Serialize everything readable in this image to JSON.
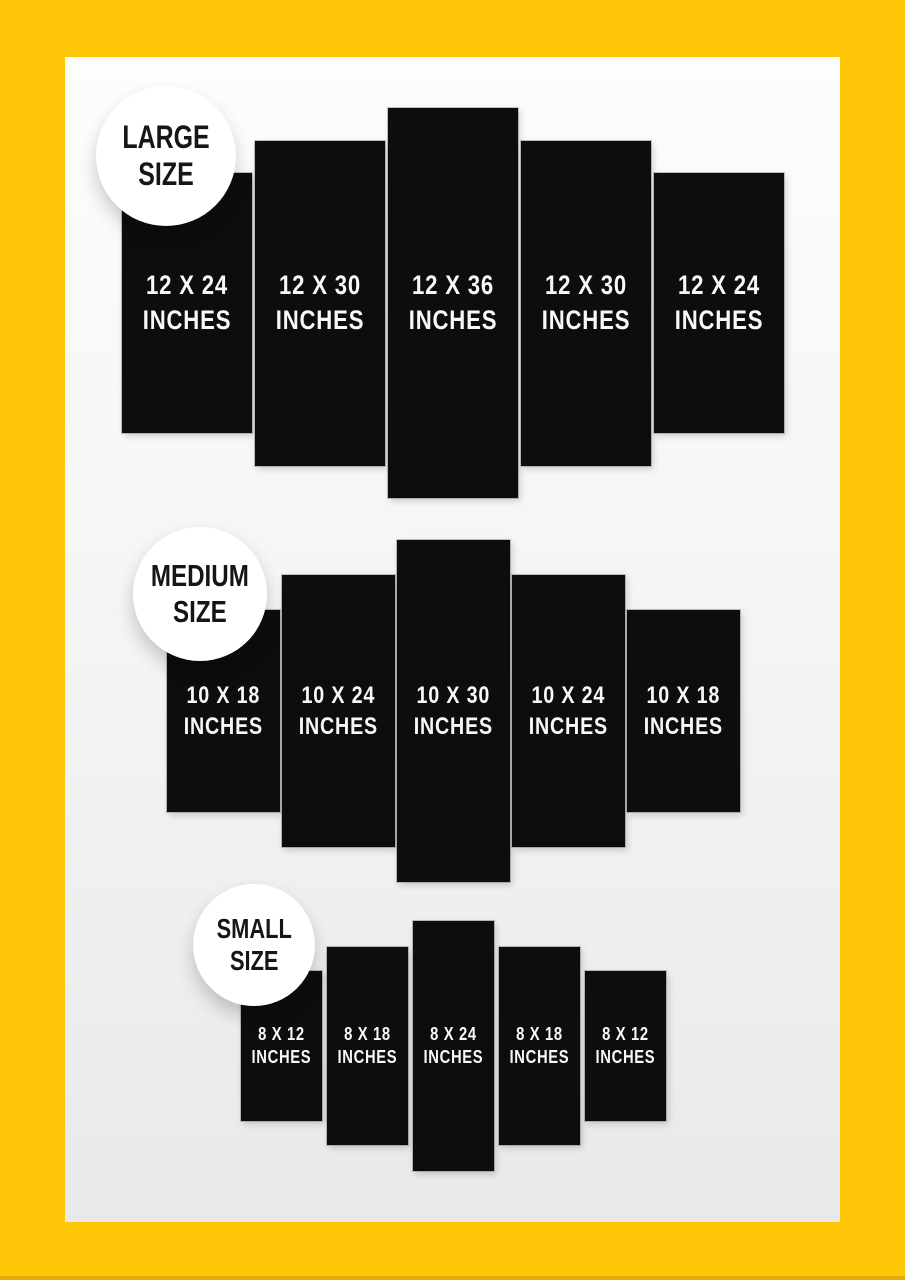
{
  "colors": {
    "frame_yellow": "#FFC708",
    "frame_bottom_shade": "#E4AC0E",
    "card_top": "#FDFDFD",
    "card_bottom": "#E9E9EB",
    "panel_black": "#0D0D0D",
    "panel_text": "#F8F8F8",
    "badge_background": "#FFFFFF",
    "badge_text": "#161616"
  },
  "groups": [
    {
      "id": "large",
      "badge": {
        "line1": "LARGE",
        "line2": "SIZE"
      },
      "panels": [
        {
          "size": "12 X 24",
          "unit": "INCHES"
        },
        {
          "size": "12 X 30",
          "unit": "INCHES"
        },
        {
          "size": "12 X 36",
          "unit": "INCHES"
        },
        {
          "size": "12 X 30",
          "unit": "INCHES"
        },
        {
          "size": "12 X 24",
          "unit": "INCHES"
        }
      ]
    },
    {
      "id": "medium",
      "badge": {
        "line1": "MEDIUM",
        "line2": "SIZE"
      },
      "panels": [
        {
          "size": "10 X 18",
          "unit": "INCHES"
        },
        {
          "size": "10 X 24",
          "unit": "INCHES"
        },
        {
          "size": "10 X 30",
          "unit": "INCHES"
        },
        {
          "size": "10 X 24",
          "unit": "INCHES"
        },
        {
          "size": "10 X 18",
          "unit": "INCHES"
        }
      ]
    },
    {
      "id": "small",
      "badge": {
        "line1": "SMALL",
        "line2": "SIZE"
      },
      "panels": [
        {
          "size": "8 X 12",
          "unit": "INCHES"
        },
        {
          "size": "8 X 18",
          "unit": "INCHES"
        },
        {
          "size": "8 X 24",
          "unit": "INCHES"
        },
        {
          "size": "8 X 18",
          "unit": "INCHES"
        },
        {
          "size": "8 X 12",
          "unit": "INCHES"
        }
      ]
    }
  ]
}
